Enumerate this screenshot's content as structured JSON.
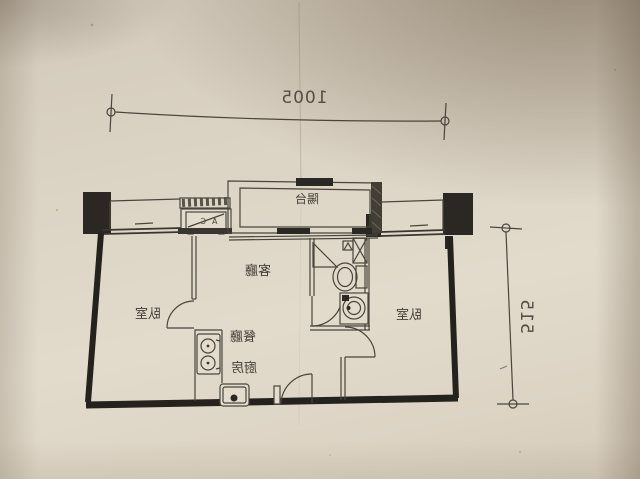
{
  "floor_plan": {
    "dimension_width": "1005",
    "dimension_height": "515",
    "rooms": {
      "balcony": "陽台",
      "living_room": "客廳",
      "dining_room": "餐廳",
      "kitchen": "廚房",
      "bedroom_left": "臥室",
      "bedroom_right": "臥室"
    },
    "ac_label": "AC",
    "symbols": [
      "air-conditioner-unit",
      "stove-two-burners",
      "kitchen-sink",
      "entry-door-swing",
      "left-bedroom-door-swing",
      "right-bedroom-door-swing",
      "bathroom-door-swing",
      "corner-shower",
      "washbasin",
      "vent-shaft-x",
      "toilet",
      "washing-machine",
      "window-bands",
      "structural-columns",
      "dimension-end-circles"
    ],
    "colors": {
      "paper": "#ddd5c6",
      "ink": "#3c3831",
      "wall_fill": "#26231f",
      "photo_shadow": "#a2937e"
    }
  }
}
